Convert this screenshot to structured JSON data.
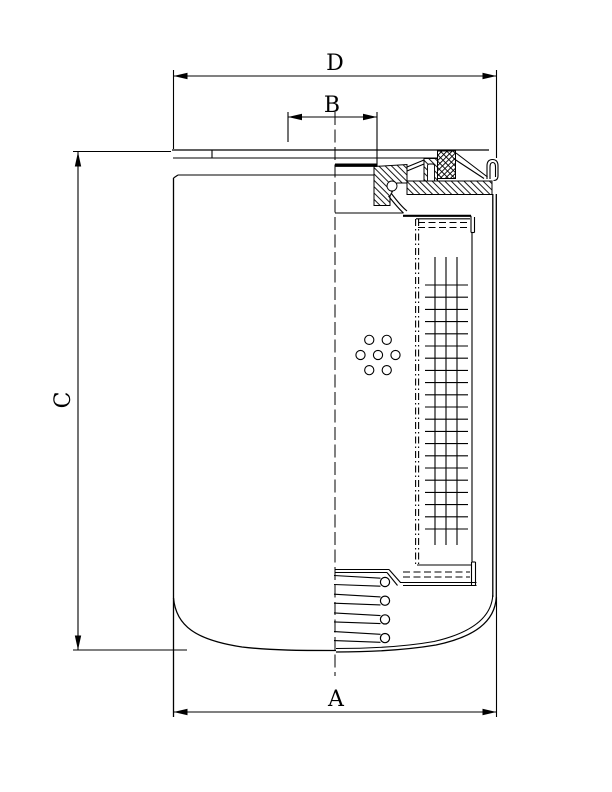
{
  "page": {
    "background": "#ffffff",
    "line_color": "#000000"
  },
  "dimensions": {
    "d": {
      "label": "D"
    },
    "b": {
      "label": "B"
    },
    "c": {
      "label": "C"
    },
    "a": {
      "label": "A"
    }
  },
  "drawing": {
    "bypass_holes": {
      "cx": 378,
      "cy": 355,
      "ring_radius": 17.5,
      "hole_radius": 4.6,
      "outer_count": 6,
      "angles_deg": [
        0,
        60,
        120,
        180,
        240,
        300
      ]
    },
    "media_grid": {
      "row_x1": 425,
      "row_x2": 468,
      "row_y_top": 285,
      "row_y_bottom": 529,
      "row_count": 21,
      "column_xs": [
        435,
        446,
        457
      ],
      "column_y_top": 257,
      "column_y_bottom": 545
    },
    "spring": {
      "coil_count": 4,
      "circle_x": 385,
      "circle_r": 4.6,
      "first_cy": 582,
      "cy_step": 18.7,
      "line_x1": 334,
      "line_x2": 380.5
    }
  }
}
